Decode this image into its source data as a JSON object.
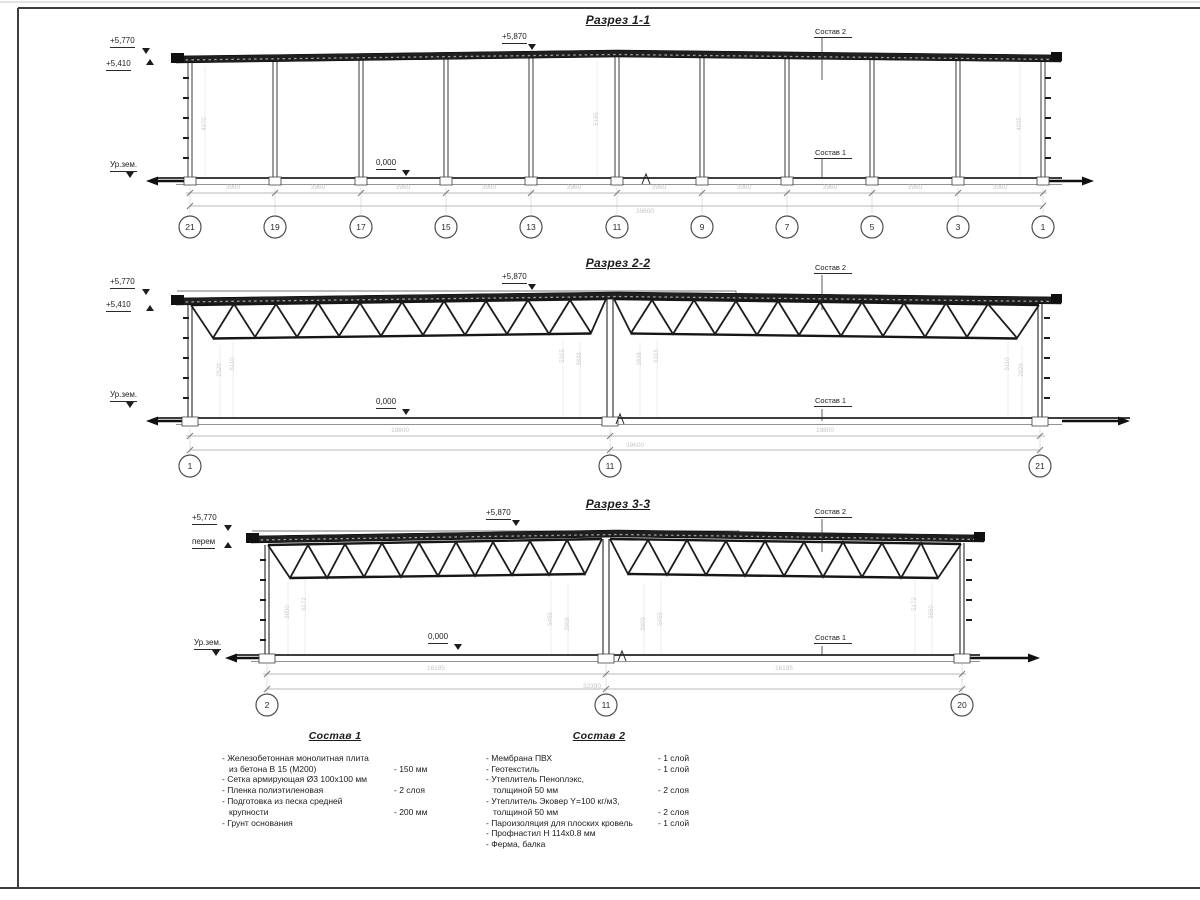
{
  "colors": {
    "line": "#2e2e2e",
    "faint": "#c6c6c6",
    "roof_fill": "#1f1f1f"
  },
  "section1": {
    "title": "Разрез 1-1",
    "elev_parapet": "+5,770",
    "elev_roof": "+5,410",
    "elev_peak": "+5,870",
    "ground": "Ур.зем.",
    "zero": "0,000",
    "layer2": "Состав 2",
    "layer1": "Состав 1",
    "bay_dim": "3960",
    "total_dim": "39600",
    "axes": [
      "21",
      "19",
      "17",
      "15",
      "13",
      "11",
      "9",
      "7",
      "5",
      "3",
      "1"
    ],
    "heights": [
      "4970",
      "5195",
      "4935"
    ]
  },
  "section2": {
    "title": "Разрез 2-2",
    "elev_parapet": "+5,770",
    "elev_roof": "+5,410",
    "elev_peak": "+5,870",
    "ground": "Ур.зем.",
    "zero": "0,000",
    "layer2": "Состав 2",
    "layer1": "Состав 1",
    "half_dim": "19800",
    "total_dim": "39600",
    "axes": [
      "1",
      "11",
      "21"
    ],
    "heights": [
      "2529",
      "5110",
      "5315",
      "3838",
      "3838",
      "5315",
      "5110",
      "2929"
    ]
  },
  "section3": {
    "title": "Разрез 3-3",
    "elev_parapet": "+5,770",
    "elev_var": "перем",
    "elev_peak": "+5,870",
    "ground": "Ур.зем.",
    "zero": "0,000",
    "layer2": "Состав 2",
    "layer1": "Состав 1",
    "half_dim": "16195",
    "total_dim": "32390",
    "axes": [
      "2",
      "11",
      "20"
    ],
    "heights": [
      "3650",
      "5172",
      "5455",
      "3909",
      "3909",
      "5455",
      "5172",
      "3650"
    ]
  },
  "sostav1": {
    "title": "Состав 1",
    "items": [
      {
        "lines": [
          "- Железобетонная  монолитная плита",
          "из бетона В 15 (М200)"
        ],
        "qty": "- 150 мм"
      },
      {
        "lines": [
          "- Сетка армирующая Ø3 100х100 мм"
        ],
        "qty": ""
      },
      {
        "lines": [
          "- Пленка полиэтиленовая"
        ],
        "qty": "-  2 слоя"
      },
      {
        "lines": [
          "- Подготовка из песка средней",
          "крупности"
        ],
        "qty": "- 200 мм"
      },
      {
        "lines": [
          "- Грунт основания"
        ],
        "qty": ""
      }
    ]
  },
  "sostav2": {
    "title": "Состав 2",
    "items": [
      {
        "lines": [
          "- Мембрана ПВХ"
        ],
        "qty": "- 1 слой"
      },
      {
        "lines": [
          "- Геотекстиль"
        ],
        "qty": "- 1 слой"
      },
      {
        "lines": [
          "- Утеплитель Пеноплэкс,",
          "толщиной 50 мм"
        ],
        "qty": "- 2 слоя"
      },
      {
        "lines": [
          "- Утеплитель Эковер Y=100 кг/м3,",
          "толщиной 50 мм"
        ],
        "qty": "- 2 слоя"
      },
      {
        "lines": [
          "- Пароизоляция для плоских кровель"
        ],
        "qty": "- 1 слой"
      },
      {
        "lines": [
          "- Профнастил Н 114х0.8 мм"
        ],
        "qty": ""
      },
      {
        "lines": [
          "- Ферма, балка"
        ],
        "qty": ""
      }
    ]
  }
}
